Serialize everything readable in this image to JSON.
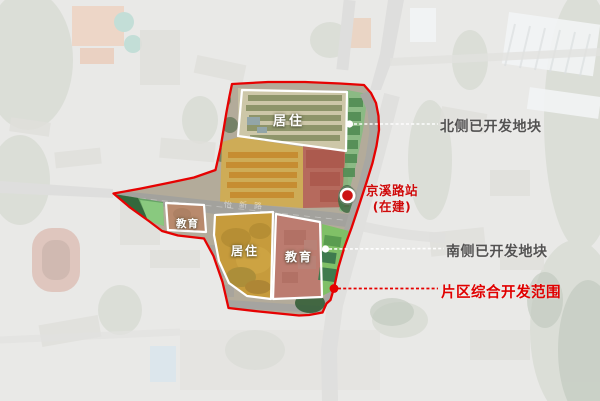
{
  "canvas": {
    "width": 600,
    "height": 401
  },
  "colors": {
    "boundary_red": "#e60202",
    "callout_text_gray": "#3e3e3e",
    "highlight_red": "#e00000",
    "station_marker_fill": "#cc1414",
    "yellow_zone_tint": "#e6ba3c",
    "red_zone_tint": "#c84a3e",
    "pink_zone_tint": "#dc8478",
    "green_zone_tint": "#7cc163",
    "tan_zone_tint": "#d7a082"
  },
  "regions": {
    "north_residential": {
      "label": "居住"
    },
    "west_education": {
      "label": "教育"
    },
    "south_residential": {
      "label": "居住"
    },
    "south_education": {
      "label": "教育"
    }
  },
  "road": {
    "name": "怡新路"
  },
  "station": {
    "line1": "京溪路站",
    "line2": "(在建)"
  },
  "callouts": {
    "north_developed": {
      "text": "北侧已开发地块"
    },
    "south_developed": {
      "text": "南侧已开发地块"
    },
    "scope": {
      "text": "片区综合开发范围"
    }
  }
}
